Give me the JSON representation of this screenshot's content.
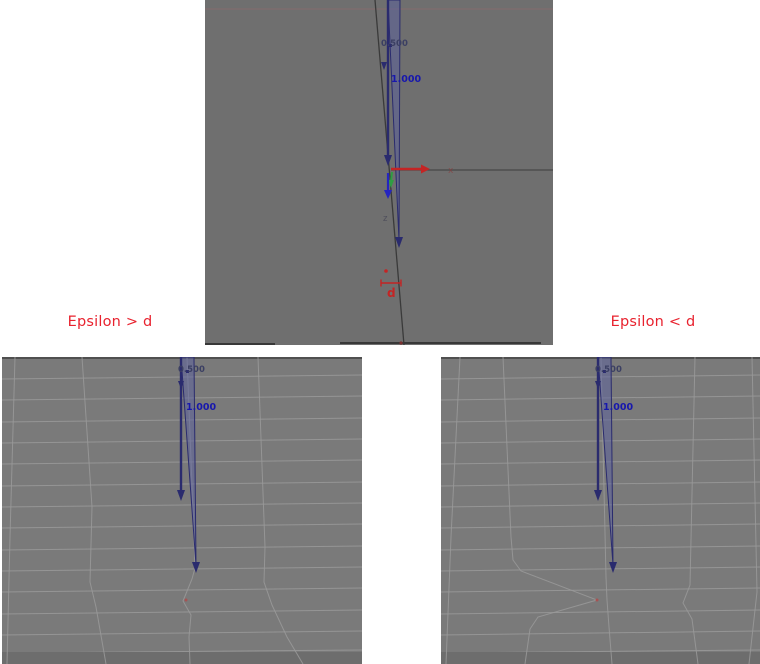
{
  "figure": {
    "description": "Vertex merge epsilon comparison figure with three 3D viewport captures"
  },
  "captions": {
    "left": "Epsilon > d",
    "right": "Epsilon < d"
  },
  "top_panel": {
    "labels": {
      "half": "0.500",
      "full": "1.000",
      "x_axis": "x",
      "z_axis": "z",
      "distance": "d"
    }
  },
  "bottom_left_panel": {
    "labels": {
      "half": "0.500",
      "full": "1.000"
    }
  },
  "bottom_right_panel": {
    "labels": {
      "half": "0.500",
      "full": "1.000"
    }
  },
  "colors": {
    "caption_red": "#e8222e",
    "axis_red": "#c42424",
    "axis_green": "#2f9e42",
    "axis_blue": "#2525c0",
    "measure_navy": "#3b3f63",
    "measure_blue": "#1717ad",
    "spike_outline": "#2a2b6e",
    "spike_fill": "rgba(90,95,160,0.5)",
    "top_panel_gray": "#6f6f6f",
    "bottom_panel_gray": "#7a7a7a",
    "grid_gray": "#9a9a9a",
    "merge_vertex_red": "#a65252"
  }
}
